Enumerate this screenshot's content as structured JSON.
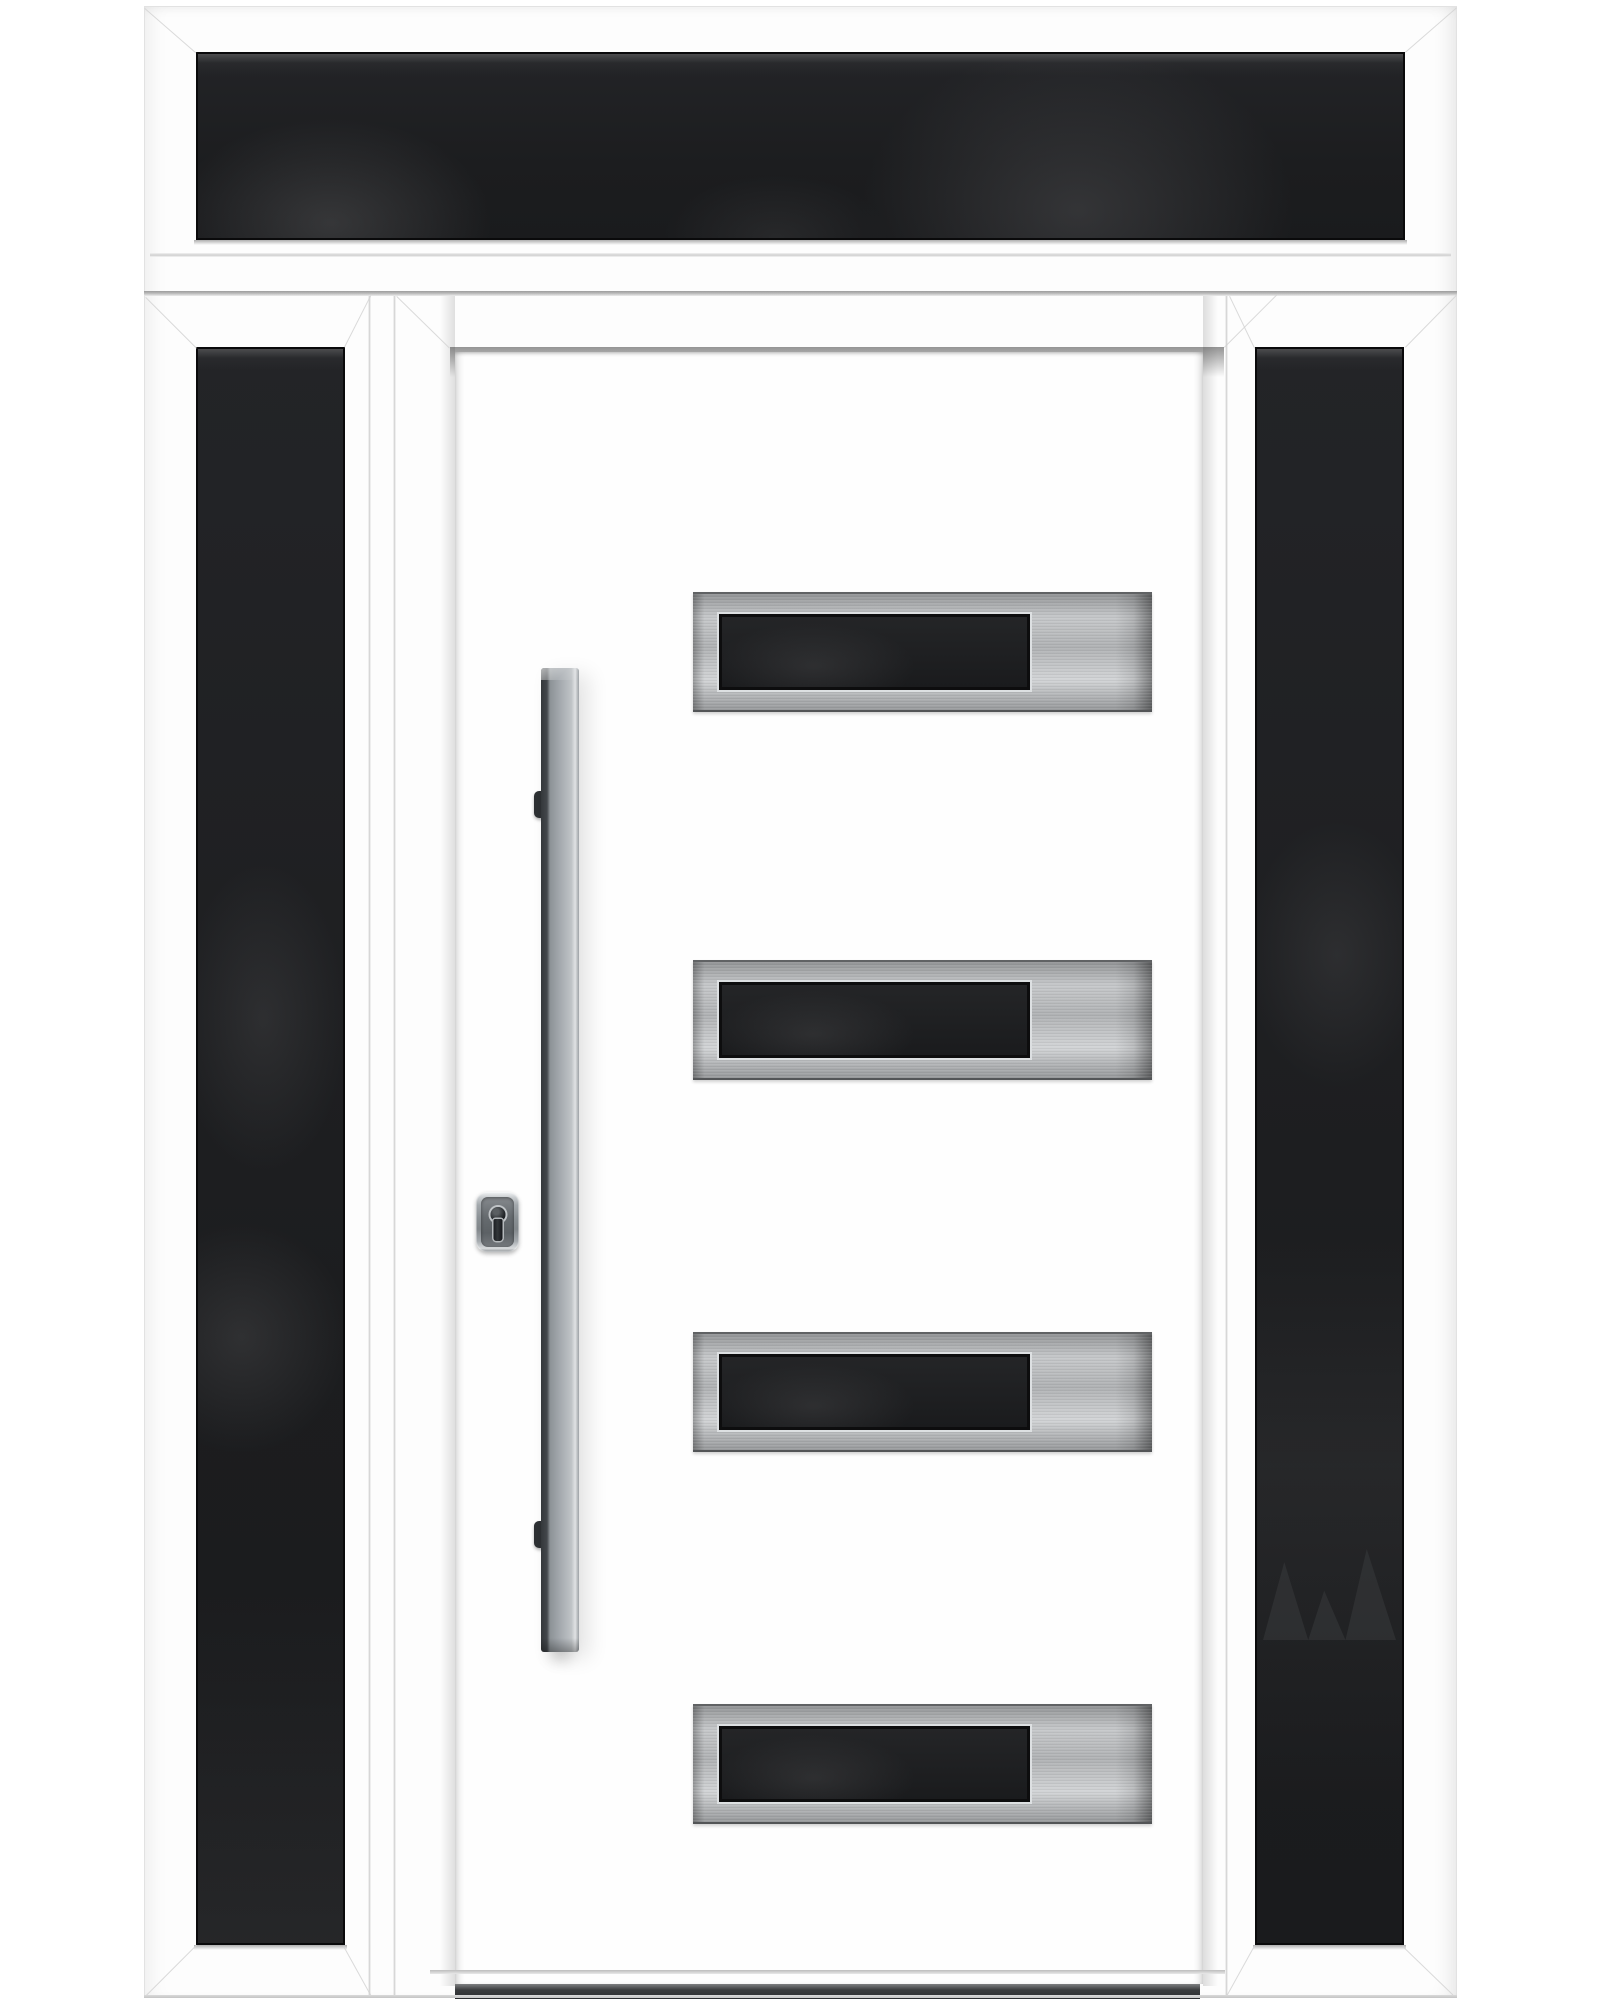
{
  "scene": {
    "type": "product-photo",
    "subject": "Modern white front entry door with dark tinted glass sidelights and transom",
    "background_color": "#ffffff"
  },
  "palette": {
    "frame_white": "#fdfdfd",
    "frame_line_gray": "#d4d4d4",
    "separator_gray": "#9c9c9c",
    "glass_black": "#1c1d1f",
    "glass_edge_black": "#0a0a0b",
    "stainless_light": "#d2d4d6",
    "stainless_mid": "#b0b2b4",
    "stainless_dark": "#606264",
    "handle_gray": "#a4a9ae",
    "handle_edge_dark": "#34383b",
    "escutcheon_gray": "#8a9094",
    "threshold_dark": "#2c2e30"
  },
  "assembly": {
    "transom": {
      "label": "Transom window with dark tinted glass"
    },
    "left_sidelight": {
      "label": "Left sidelight with dark tinted glass"
    },
    "right_sidelight": {
      "label": "Right sidelight with dark tinted glass"
    },
    "door": {
      "label": "White entry door slab",
      "glass_inserts": {
        "count": 4,
        "label": "Stainless-steel framed dark glass insert"
      },
      "handle": {
        "label": "Long vertical stainless-steel pull handle"
      },
      "handle_bracket_label": "Handle mounting bracket",
      "lock": {
        "label": "Security escutcheon with euro-profile keyhole"
      },
      "threshold": {
        "label": "Dark metal threshold sill"
      }
    }
  }
}
